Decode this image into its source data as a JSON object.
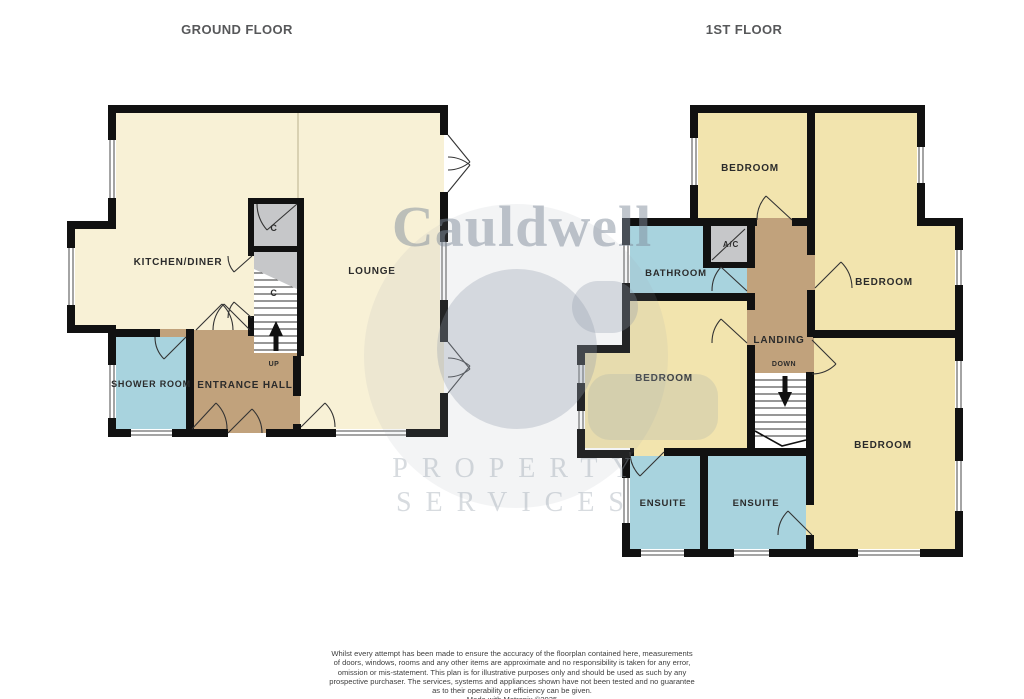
{
  "titles": {
    "ground": "GROUND FLOOR",
    "first": "1ST FLOOR"
  },
  "watermark": {
    "brand": "Cauldwell",
    "word1": "PROPERTY",
    "word2": "SERVICES"
  },
  "ground_floor": {
    "labels": {
      "kitchen": "KITCHEN/DINER",
      "lounge": "LOUNGE",
      "shower": "SHOWER ROOM",
      "hall": "ENTRANCE HALL",
      "cupboard_top": "C",
      "cupboard_under_stairs": "C",
      "stairs_direction": "UP"
    }
  },
  "first_floor": {
    "labels": {
      "bedroom_top_left": "BEDROOM",
      "bedroom_right": "BEDROOM",
      "bedroom_mid_left": "BEDROOM",
      "bedroom_bottom_right": "BEDROOM",
      "bathroom": "BATHROOM",
      "airing_cupboard": "A/C",
      "landing": "LANDING",
      "stairs_direction": "DOWN",
      "ensuite_left": "ENSUITE",
      "ensuite_right": "ENSUITE"
    }
  },
  "colors": {
    "wall": "#111111",
    "ground_room": "#F8F1D6",
    "first_room": "#F2E4AE",
    "wet_room": "#A8D3DE",
    "hall": "#C1A27C",
    "cupboard_gray": "#C6C7C9",
    "stairs_white": "#FFFFFF",
    "watermark_gray": "#8E99A8"
  },
  "disclaimer": {
    "lines": [
      "Whilst every attempt has been made to ensure the accuracy of the floorplan contained here, measurements",
      "of doors, windows, rooms and any other items are approximate and no responsibility is taken for any error,",
      "omission or mis-statement. This plan is for illustrative purposes only and should be used as such by any",
      "prospective purchaser. The services, systems and appliances shown have not been tested and no guarantee",
      "as to their operability or efficiency can be given.",
      "Made with Metropix ©2025"
    ]
  }
}
